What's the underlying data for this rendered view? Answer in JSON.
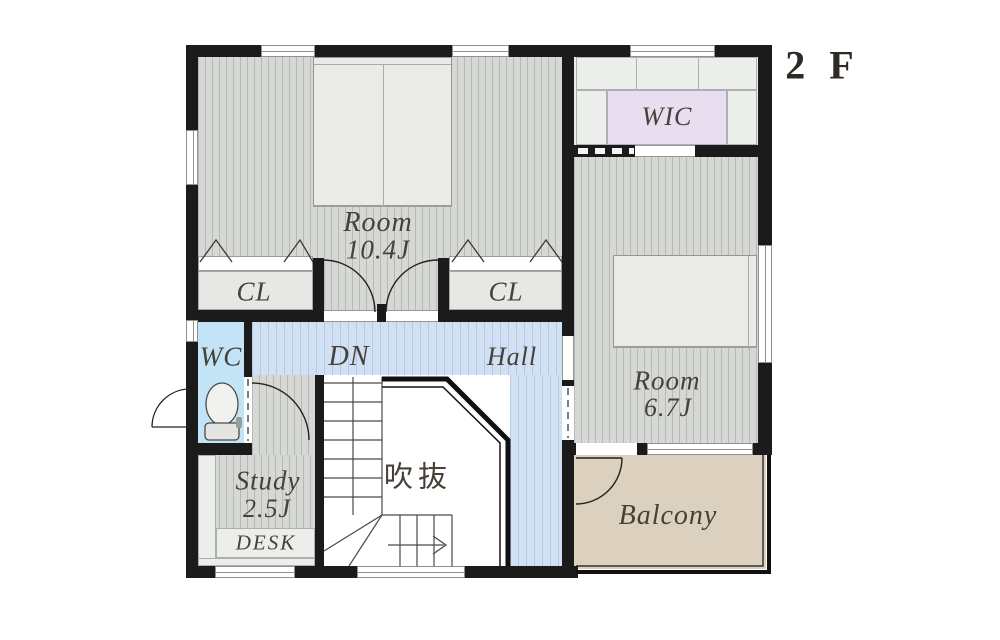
{
  "floor_label": "2 F",
  "rooms": {
    "room_main": {
      "name": "Room",
      "size": "10.4J"
    },
    "closet_left": {
      "label": "CL"
    },
    "closet_right": {
      "label": "CL"
    },
    "wic": {
      "label": "WIC"
    },
    "room_sub": {
      "name": "Room",
      "size": "6.7J"
    },
    "wc": {
      "label": "WC"
    },
    "stairs": {
      "down_label": "DN"
    },
    "hall": {
      "label": "Hall"
    },
    "void": {
      "label": "吹抜"
    },
    "study": {
      "name": "Study",
      "size": "2.5J",
      "desk_label": "DESK"
    },
    "balcony": {
      "label": "Balcony"
    }
  },
  "colors": {
    "wall": "#1b1b1b",
    "floor_gray": "#d6d8d5",
    "hall_blue": "#d2e0f3",
    "wc_blue": "#c3e3f7",
    "wic_lavender": "#e7def0",
    "balcony_tan": "#dbd1be",
    "furniture": "#eaebe9",
    "label_text": "#474038"
  }
}
